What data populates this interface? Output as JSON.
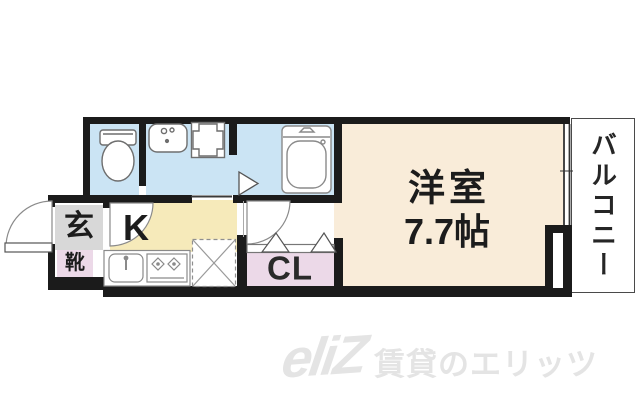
{
  "rooms": {
    "entrance": {
      "label": "玄"
    },
    "shoes": {
      "label": "靴"
    },
    "kitchen": {
      "label": "K"
    },
    "closet": {
      "label": "CL"
    },
    "western_room": {
      "label": "洋室",
      "size": "7.7帖"
    },
    "balcony": {
      "label": "バルコニー"
    }
  },
  "watermark": {
    "logo": "eliZ",
    "text": "賃貸のエリッツ"
  },
  "colors": {
    "wall": "#1b1b1b",
    "water": "#cbe4f4",
    "cream": "#f9ecd9",
    "yellow": "#f6eaba",
    "pink": "#ecd9e8",
    "gray": "#d8d8d8",
    "wm": "#e4e4e4"
  }
}
